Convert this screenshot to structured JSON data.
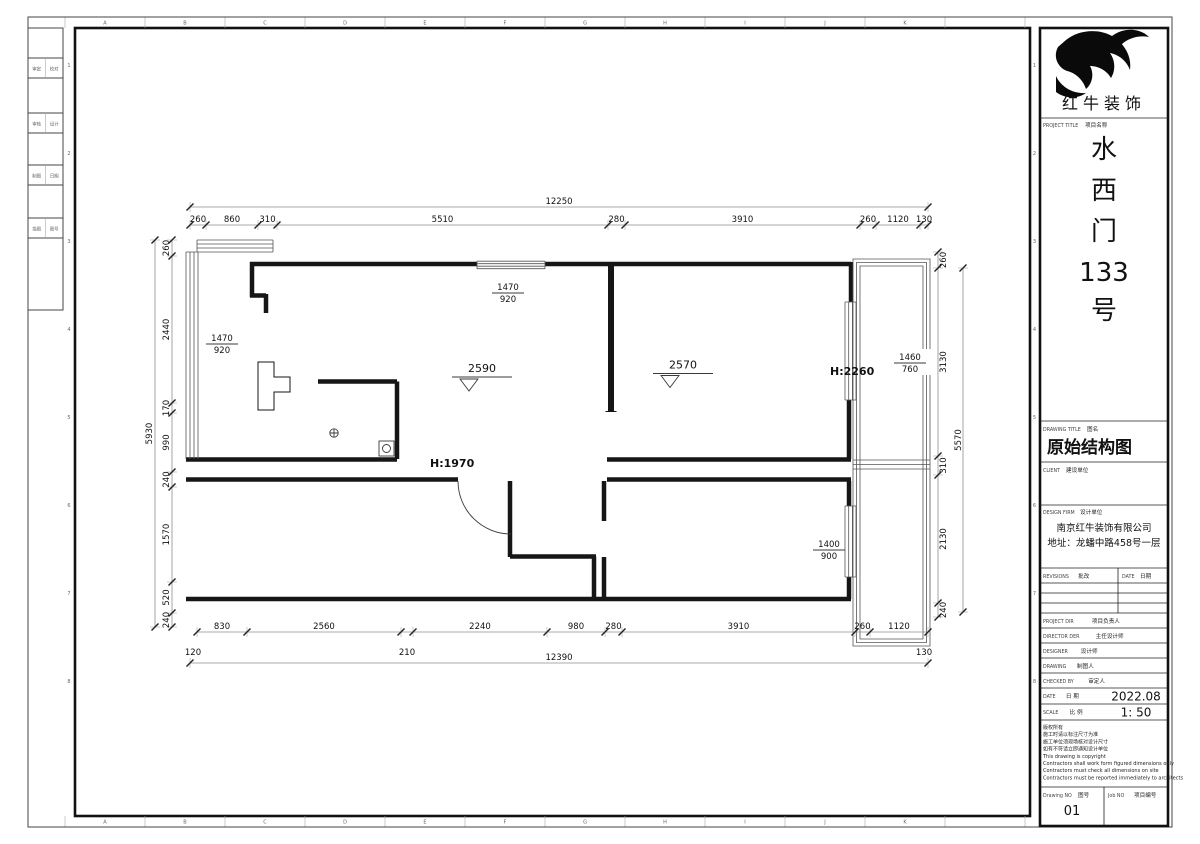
{
  "sheet": {
    "grid_letters": [
      "A",
      "B",
      "C",
      "D",
      "E",
      "F",
      "G",
      "H",
      "I",
      "J",
      "K"
    ],
    "grid_numbers": [
      "1",
      "2",
      "3",
      "4",
      "5",
      "6",
      "7",
      "8"
    ],
    "stamp_cells": [
      [
        "审定",
        "校对"
      ],
      [
        "审核",
        "设计"
      ],
      [
        "制图",
        "日期"
      ],
      [
        "描图",
        "图号"
      ]
    ]
  },
  "title_block": {
    "brand": "红牛装饰",
    "project_label_en": "PROJECT TITLE",
    "project_label_cn": "项目名称",
    "project_name_chars": [
      "水",
      "西",
      "门",
      "133",
      "号"
    ],
    "drawing_title_label_en": "DRAWING TITLE",
    "drawing_title_label_cn": "图名",
    "drawing_title": "原始结构图",
    "client_label_en": "CLIENT",
    "client_label_cn": "建设单位",
    "design_firm_label_en": "DESIGN FIRM",
    "design_firm_label_cn": "设计单位",
    "design_firm_name": "南京红牛装饰有限公司",
    "design_firm_address": "地址：龙蟠中路458号一层",
    "revisions_label_en": "REVISIONS",
    "revisions_label_cn": "批改",
    "date_col_en": "DATE",
    "date_col_cn": "日期",
    "staff_rows": [
      {
        "en": "PROJECT DIR",
        "cn": "项目负责人",
        "value": ""
      },
      {
        "en": "DIRECTOR DER",
        "cn": "主任设计师",
        "value": ""
      },
      {
        "en": "DESIGNER",
        "cn": "设计师",
        "value": ""
      },
      {
        "en": "DRAWING",
        "cn": "制图人",
        "value": ""
      },
      {
        "en": "CHECKED BY",
        "cn": "审定人",
        "value": ""
      },
      {
        "en": "DATE",
        "cn": "日 期",
        "value": "2022.08"
      },
      {
        "en": "SCALE",
        "cn": "比 例",
        "value": "1: 50"
      }
    ],
    "notes": [
      "版权所有",
      "施工时请以标注尺寸为准",
      "施工单位须现场核对设计尺寸",
      "如有不符请立即通知设计单位",
      "This drawing is copyright",
      "Contractors shall work form figured dimensions only",
      "Contractors must check all dimensions on site",
      "Contractors must be reported immediately to architects"
    ],
    "drawing_no_label_en": "Drawing NO",
    "drawing_no_label_cn": "图号",
    "drawing_no": "01",
    "job_no_label_en": "Job NO",
    "job_no_label_cn": "项目编号"
  },
  "plan": {
    "levels": [
      {
        "value": "2590"
      },
      {
        "value": "2570"
      }
    ],
    "heights": [
      {
        "value": "H:2260"
      },
      {
        "value": "H:1970"
      }
    ],
    "windows": [
      {
        "w": "1470",
        "h": "920"
      },
      {
        "w": "1470",
        "h": "920"
      },
      {
        "w": "1460",
        "h": "760"
      },
      {
        "w": "1400",
        "h": "900"
      }
    ],
    "dimensions": [
      {
        "dir": "h",
        "pos": 207,
        "ticks": [
          190,
          928
        ],
        "labels": [
          "12250"
        ]
      },
      {
        "dir": "h",
        "pos": 225,
        "ticks": [
          190,
          206,
          258,
          277,
          608,
          625,
          860,
          876,
          920,
          928
        ],
        "labels": [
          "260",
          "860",
          "310",
          "5510",
          "280",
          "3910",
          "260",
          "1120",
          "130"
        ]
      },
      {
        "dir": "h",
        "pos": 632,
        "ticks": [
          197,
          247,
          401,
          413,
          547,
          605,
          622,
          855,
          870,
          928
        ],
        "labels": [
          "830",
          "2560",
          "",
          "2240",
          "980",
          "280",
          "3910",
          "260",
          "1120"
        ]
      },
      {
        "dir": "h",
        "pos": 663,
        "ticks": [
          190,
          928
        ],
        "labels": [
          "12390"
        ]
      },
      {
        "dir": "v",
        "pos": 172,
        "toff": -3,
        "ticks": [
          240,
          256,
          403,
          413,
          472,
          487,
          582,
          613,
          627
        ],
        "labels": [
          "260",
          "2440",
          "170",
          "990",
          "240",
          "1570",
          "520",
          "240"
        ]
      },
      {
        "dir": "v",
        "pos": 155,
        "toff": -3,
        "ticks": [
          240,
          627
        ],
        "labels": [
          "5930"
        ]
      },
      {
        "dir": "v",
        "pos": 938,
        "toff": 8,
        "ticks": [
          252,
          268,
          456,
          475,
          603,
          617
        ],
        "labels": [
          "260",
          "3130",
          "310",
          "2130",
          "240"
        ]
      },
      {
        "dir": "v",
        "pos": 963,
        "toff": -2,
        "ticks": [
          268,
          612
        ],
        "labels": [
          "5570"
        ]
      }
    ],
    "free_labels": [
      {
        "text": "120",
        "x": 193,
        "y": 655
      },
      {
        "text": "210",
        "x": 407,
        "y": 655
      },
      {
        "text": "130",
        "x": 924,
        "y": 655
      }
    ]
  }
}
